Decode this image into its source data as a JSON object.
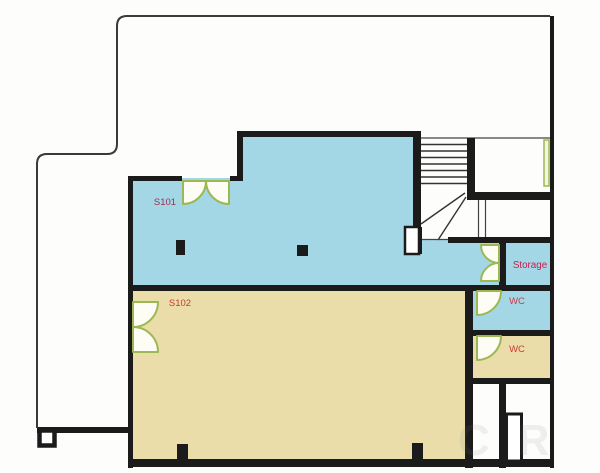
{
  "document": {
    "type": "floor-plan"
  },
  "rooms": {
    "s101": {
      "label": "S101",
      "label_color": "#9e2b50",
      "fill": "#a3d7e6"
    },
    "s102": {
      "label": "S102",
      "label_color": "#c43a2c",
      "fill": "#eaddaa"
    },
    "storage": {
      "label": "Storage",
      "label_color": "#c22052",
      "fill": "#a3d7e6"
    },
    "wc_upper": {
      "label": "WC",
      "label_color": "#cd3a47",
      "fill": "#a3d7e6"
    },
    "wc_lower": {
      "label": "WC",
      "label_color": "#d23a31",
      "fill": "#eaddaa"
    }
  },
  "palette": {
    "wall": "#1b1b1b",
    "outline": "#3a3a3a",
    "door_stroke": "#9cb851",
    "door_fill": "#fdfdf6",
    "stair_line": "#333333",
    "background": "#fdfdfb"
  },
  "watermark": {
    "text": "CR"
  }
}
